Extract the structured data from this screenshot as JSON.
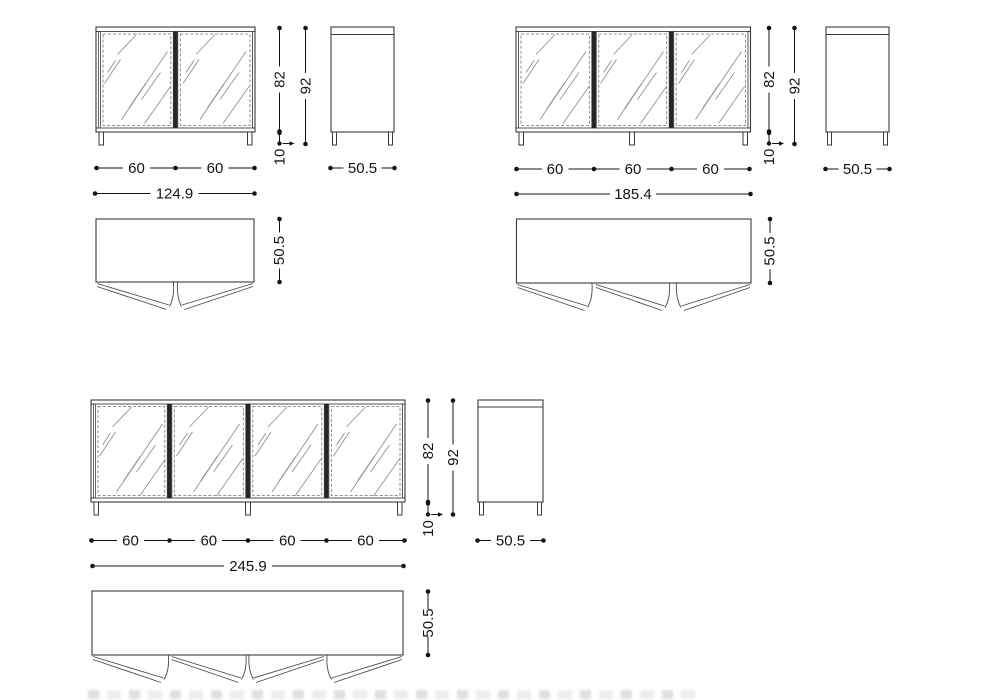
{
  "drawing_type": "furniture technical drawing - glass door sideboards, three sizes, front/side/plan views",
  "sets": [
    {
      "name": "sideboard-2-door",
      "front": {
        "doors": [
          "60",
          "60"
        ],
        "total_width": "124.9",
        "body_height": "82",
        "total_height": "92",
        "leg_height": "10"
      },
      "side": {
        "depth": "50.5"
      },
      "plan": {
        "depth": "50.5"
      }
    },
    {
      "name": "sideboard-3-door",
      "front": {
        "doors": [
          "60",
          "60",
          "60"
        ],
        "total_width": "185.4",
        "body_height": "82",
        "total_height": "92",
        "leg_height": "10"
      },
      "side": {
        "depth": "50.5"
      },
      "plan": {
        "depth": "50.5"
      }
    },
    {
      "name": "sideboard-4-door",
      "front": {
        "doors": [
          "60",
          "60",
          "60",
          "60"
        ],
        "total_width": "245.9",
        "body_height": "82",
        "total_height": "92",
        "leg_height": "10"
      },
      "side": {
        "depth": "50.5"
      },
      "plan": {
        "depth": "50.5"
      }
    }
  ],
  "colors": {
    "line": "#3b3b3b",
    "dimension": "#141414",
    "hatch": "#919191",
    "door_divider": "#262626",
    "dashed_frame": "#6f6f6f",
    "background": "#ffffff"
  }
}
